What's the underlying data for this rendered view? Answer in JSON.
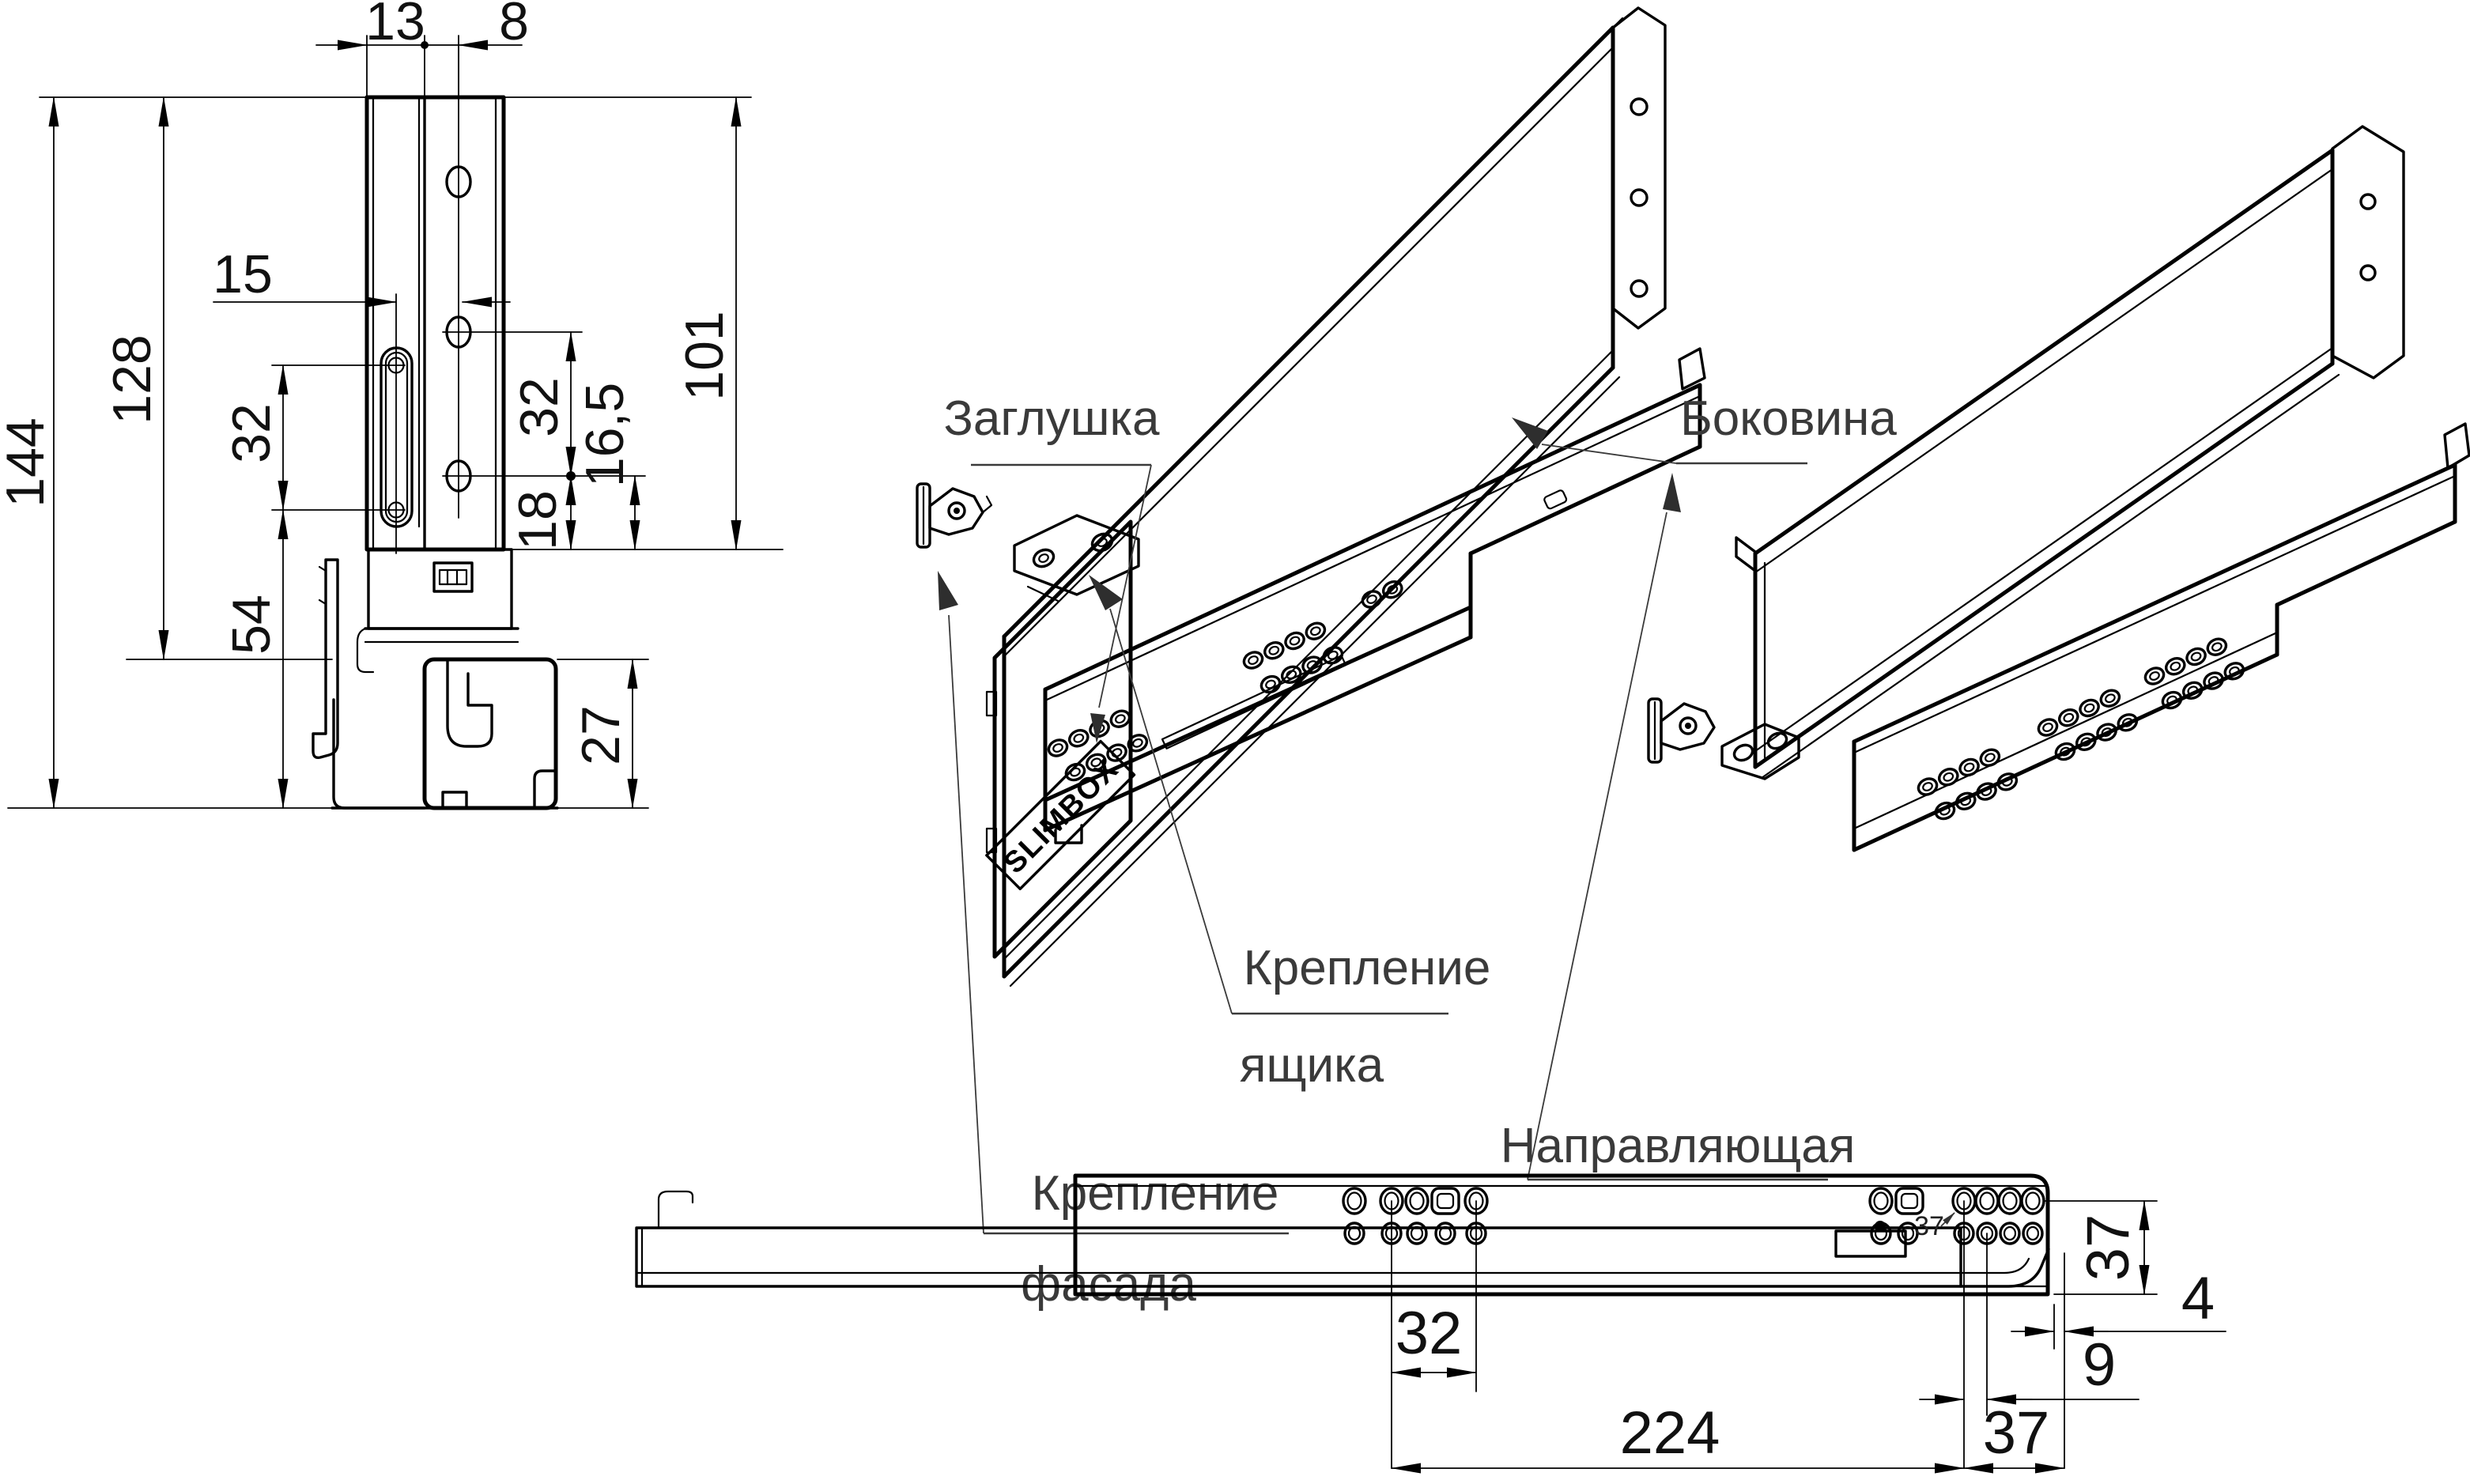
{
  "colors": {
    "background": "#ffffff",
    "line": "#000000",
    "label_text": "#3a3a3a",
    "dim_text": "#111111"
  },
  "product_marking": {
    "logo": "SLIMBOX"
  },
  "callouts": {
    "cap": "Заглушка",
    "side_panel": "Боковина",
    "drawer_mount_line1": "Крепление",
    "drawer_mount_line2": "ящика",
    "front_mount_line1": "Крепление",
    "front_mount_line2": "фасада",
    "guide_rail": "Направляющая"
  },
  "section_view_dims": {
    "panel_width": "13",
    "hole_offset": "8",
    "slot_offset": "15",
    "overall_height": "144",
    "panel_height": "128",
    "slot_pitch": "32",
    "lower_height": "54",
    "hole_field_height": "101",
    "hole_pitch": "32",
    "hole_to_base": "16,5",
    "lower_hole_gap": "18",
    "rail_height": "27"
  },
  "side_view_dims": {
    "hole_pitch": "32",
    "mounting_length": "224",
    "rear_offset": "37",
    "hole_edge_offset": "9",
    "tail_length": "4",
    "rail_height": "37",
    "hole_callout": "37"
  }
}
